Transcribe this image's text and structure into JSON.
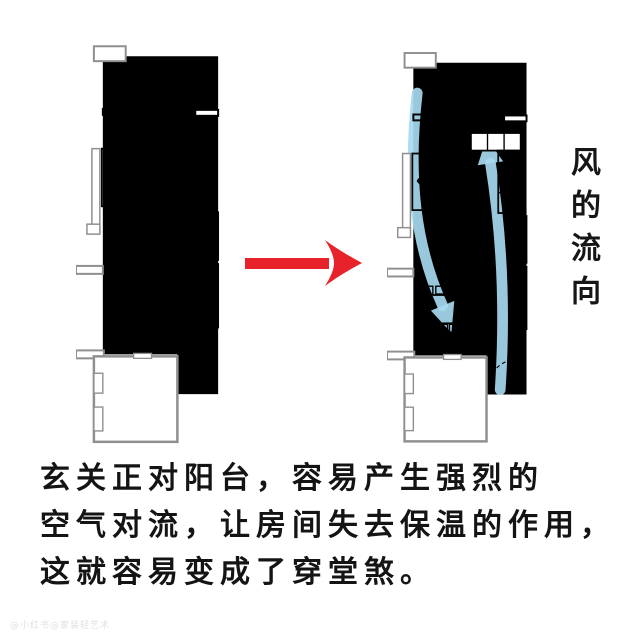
{
  "colors": {
    "room_fill": "#f3c6a9",
    "plan_stroke_before": "#a9653f",
    "plan_stroke_after": "#6e6e6e",
    "airflow_blue": "#a6d9ef",
    "arrow_red": "#e8222a",
    "text_black": "#141414"
  },
  "left_plan": {
    "watermark": "家装轻艺术"
  },
  "right_plan": {
    "watermark": "家装轻艺术"
  },
  "wind_label": "风的流向",
  "caption": {
    "line1": "玄关正对阳台，容易产生强烈的",
    "line2": "空气对流，让房间失去保温的作用，",
    "line3": "这就容易变成了穿堂煞。"
  },
  "footer_watermark": "@小红书@家装轻艺术"
}
